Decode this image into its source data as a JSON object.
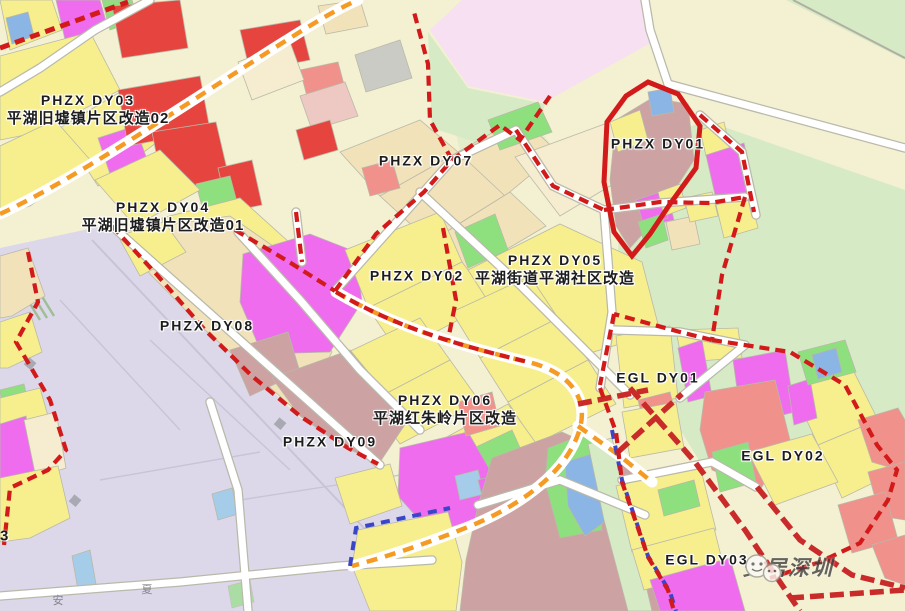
{
  "map": {
    "zones": [
      {
        "id": "phzx-dy03",
        "code": "PHZX DY03",
        "name": "平湖旧墟镇片区改造02"
      },
      {
        "id": "phzx-dy04",
        "code": "PHZX DY04",
        "name": "平湖旧墟镇片区改造01"
      },
      {
        "id": "phzx-dy07",
        "code": "PHZX DY07",
        "name": ""
      },
      {
        "id": "phzx-dy02",
        "code": "PHZX DY02",
        "name": ""
      },
      {
        "id": "phzx-dy05",
        "code": "PHZX DY05",
        "name": "平湖街道平湖社区改造"
      },
      {
        "id": "phzx-dy01",
        "code": "PHZX DY01",
        "name": ""
      },
      {
        "id": "phzx-dy08",
        "code": "PHZX DY08",
        "name": ""
      },
      {
        "id": "phzx-dy09",
        "code": "PHZX DY09",
        "name": ""
      },
      {
        "id": "phzx-dy06",
        "code": "PHZX DY06",
        "name": "平湖红朱岭片区改造"
      },
      {
        "id": "egl-dy01",
        "code": "EGL DY01",
        "name": ""
      },
      {
        "id": "egl-dy02",
        "code": "EGL DY02",
        "name": ""
      },
      {
        "id": "egl-dy03",
        "code": "EGL DY03",
        "name": ""
      }
    ],
    "partial_label": "3",
    "road_labels": {
      "a": "安",
      "b": "夏"
    },
    "watermark": {
      "text": "安居深圳"
    },
    "colors": {
      "yellow": "#f7ef8e",
      "magenta": "#ee6ced",
      "red": "#e6453f",
      "salmon": "#f0918b",
      "mauve": "#cda2a2",
      "tan": "#f1e2ba",
      "tan_light": "#f6ecd0",
      "green": "#8ee07e",
      "green_bg": "#d7eac6",
      "cream": "#f4f0d2",
      "lavender": "#dcd8e9",
      "pale_pink": "#f6e0f1",
      "blue": "#8ab5e4",
      "blue_light": "#a5cdea",
      "gray": "#cbcbc6",
      "dusty_pink": "#eec9c4",
      "orange_road": "#f59b24",
      "red_boundary": "#d21a1a",
      "red_road": "#c92a2a",
      "blue_line": "#3a46c8",
      "label": "#1c1c1c"
    }
  }
}
